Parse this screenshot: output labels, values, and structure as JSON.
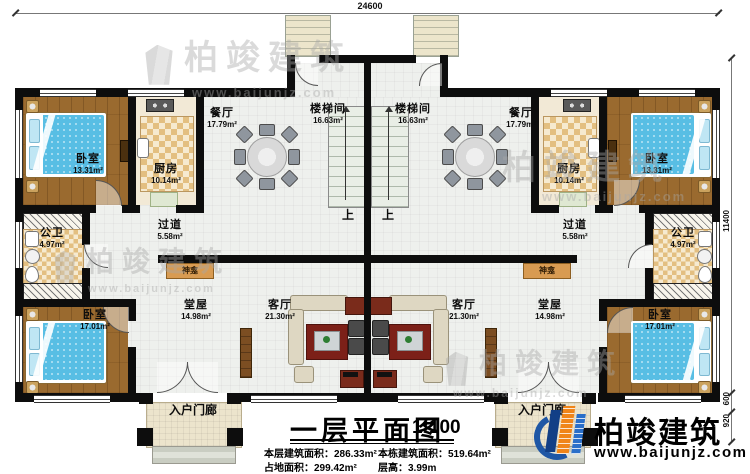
{
  "dimensions": {
    "total_width": "24600",
    "total_height": "11400",
    "right_seg_600": "600",
    "right_seg_920": "920"
  },
  "rooms": [
    {
      "id": "bedroom-top-left",
      "name": "卧室",
      "area": "13.31m²"
    },
    {
      "id": "kitchen-left",
      "name": "厨房",
      "area": "10.14m²"
    },
    {
      "id": "dining-left",
      "name": "餐厅",
      "area": "17.79m²"
    },
    {
      "id": "stairwell-left",
      "name": "楼梯间",
      "area": "16.63m²"
    },
    {
      "id": "hallway-left",
      "name": "过道",
      "area": "5.58m²"
    },
    {
      "id": "bathroom-left",
      "name": "公卫",
      "area": "4.97m²"
    },
    {
      "id": "bedroom-bottom-left",
      "name": "卧室",
      "area": "17.01m²"
    },
    {
      "id": "main-hall-left",
      "name": "堂屋",
      "area": "14.98m²"
    },
    {
      "id": "living-room-left",
      "name": "客厅",
      "area": "21.30m²"
    },
    {
      "id": "stairwell-right",
      "name": "楼梯间",
      "area": "16.63m²"
    },
    {
      "id": "dining-right",
      "name": "餐厅",
      "area": "17.79m²"
    },
    {
      "id": "kitchen-right",
      "name": "厨房",
      "area": "10.14m²"
    },
    {
      "id": "bedroom-top-right",
      "name": "卧室",
      "area": "13.31m²"
    },
    {
      "id": "hallway-right",
      "name": "过道",
      "area": "5.58m²"
    },
    {
      "id": "bathroom-right",
      "name": "公卫",
      "area": "4.97m²"
    },
    {
      "id": "living-room-right",
      "name": "客厅",
      "area": "21.30m²"
    },
    {
      "id": "main-hall-right",
      "name": "堂屋",
      "area": "14.98m²"
    },
    {
      "id": "bedroom-bottom-right",
      "name": "卧室",
      "area": "17.01m²"
    }
  ],
  "annotations": {
    "shrine": "神龛",
    "up": "上",
    "entry_porch": "入户门廊"
  },
  "title_block": {
    "title": "一层平面图",
    "scale": "1:100",
    "stats": [
      {
        "label": "本层建筑面积：",
        "value": "286.33m²"
      },
      {
        "label": "本栋建筑面积：",
        "value": "519.64m²"
      },
      {
        "label": "占地面积：",
        "value": "299.42m²"
      },
      {
        "label": "层高：",
        "value": "3.99m"
      }
    ]
  },
  "brand": {
    "name": "柏竣建筑",
    "url": "www.baijunjz.com"
  },
  "colors": {
    "wall": "#0d0d0d",
    "wood_floor": "#9a6a2f",
    "bed_blue": "#58bee4",
    "logo_blue": "#1f57a5",
    "logo_orange": "#f08519",
    "tv_cabinet_red": "#7a2b1b",
    "shrine_tan": "#d89b52"
  }
}
